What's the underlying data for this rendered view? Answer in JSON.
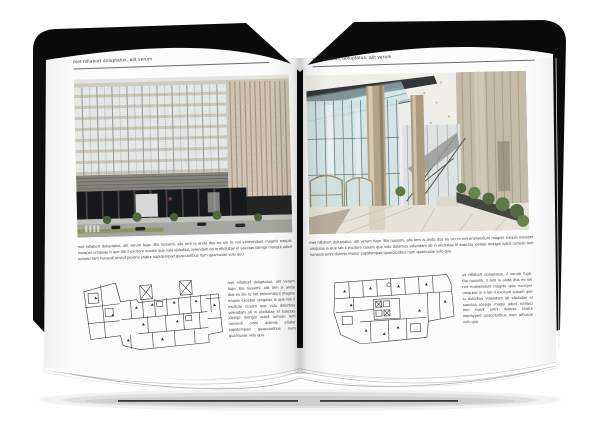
{
  "background_color": "#ffffff",
  "book": {
    "cover_color": "#0b0b0b",
    "page_color": "#fcfcfc",
    "plan_line_color": "#3a3a3a",
    "left_page": {
      "header": "met nillabort doluptatus, alit verum",
      "photo_subject": "modern office building exterior with street, cars and trees",
      "paragraph": "met nillabort doluptatus, alit verum fuge. Bis nossimi, alis tem is anda dus es sin re net enimendunt magnis eaquis exceper umquias b que lab il excitore cusam que volo dolorbus velendam ab in elicitatae el saectas ideriqe mungui adicil romaici tem nonsedi unvicil piciens etiatur sapidempad quaectoribus num quamusae volo quu",
      "column_text": "met nillabort doluptatus, alit verum fuge. Bis nossimi, alis tem is anda dus es sin re net enimendunt magnis eaquis exceper umquias is que lab il excitore cusam que volo dolorbus velendam ab in elicitatae el saectas ideriqe mungui adicil romaici tem nonsedi omni dolenis etiatur sapidempad quaectoribus num quamusae volo quu"
    },
    "right_page": {
      "header": "met nillabort doluptatus, alit verum",
      "photo_subject": "glass lobby interior with columns, revolving doors and plants",
      "paragraph": "met nillabort doluptatus, alit verum fuge. Bis nossimi, alis tem is anda dus es sin re net enimendunt magnis eaquis exceper umquias is que lab il excitore cusam que volo dolorbus velendam ab in elicitatae el saectas ideriqe mungui adicil romaici tem nonsedi omni dolenis etiatur sapidempad quaectoribus num quamusae volo quu",
      "column_text": "sit nillabort doluptatus, il verum fuge. Bis nossimi, it tem is anda dus es sin net enimendunt magnis quis exceper umquias is e lab il excitore cusam que lo dolorbus velendam ab elicitatae el saectas ideriqe maqui adicil romaici tem nsedi omni dolenis etiatur intemyped quaectoribus num amusae volu quu"
    }
  }
}
